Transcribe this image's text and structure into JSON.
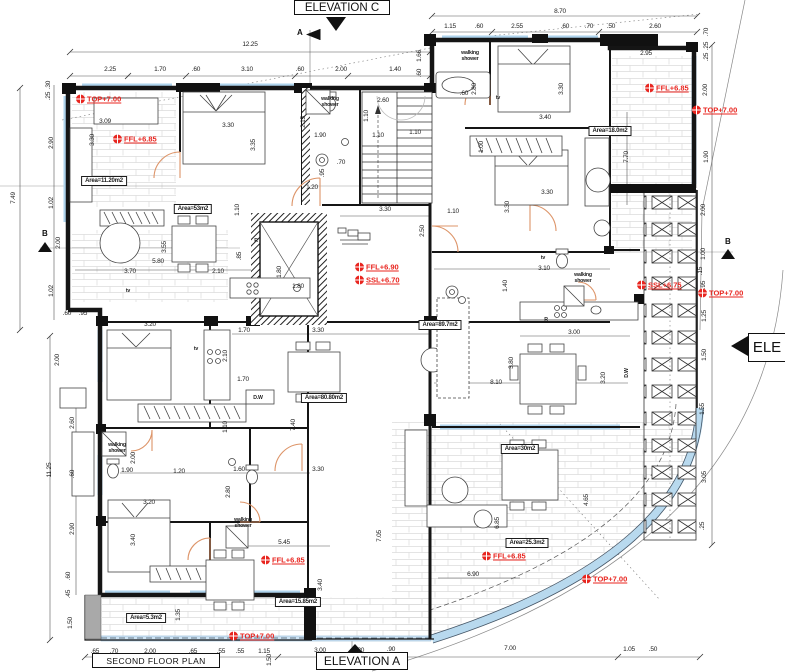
{
  "titles": {
    "plan": "SECOND FLOOR PLAN",
    "elevation_a": "ELEVATION A",
    "elevation_c": "ELEVATION C",
    "elevation_right": "ELE",
    "section_a": "A",
    "section_b": "B"
  },
  "colors": {
    "annotation_red": "#e8251f",
    "window_blue": "#aed3ec",
    "door_orange": "#dd9468",
    "wall_black": "#151515"
  },
  "red_annotations": [
    {
      "t": "TOP+7.00",
      "x": 76,
      "y": 99,
      "m": 1
    },
    {
      "t": "FFL+6.85",
      "x": 113,
      "y": 139,
      "m": 1
    },
    {
      "t": "FFL+6.85",
      "x": 645,
      "y": 88,
      "m": 1
    },
    {
      "t": "TOP+7.00",
      "x": 692,
      "y": 110,
      "m": 1
    },
    {
      "t": "FFL+6.90",
      "x": 355,
      "y": 267,
      "m": 1
    },
    {
      "t": "SSL+6.70",
      "x": 355,
      "y": 280,
      "m": 1
    },
    {
      "t": "SSL+6.75",
      "x": 637,
      "y": 285,
      "m": 1
    },
    {
      "t": "TOP+7.00",
      "x": 698,
      "y": 293,
      "m": 1
    },
    {
      "t": "FFL+6.85",
      "x": 261,
      "y": 560,
      "m": 1
    },
    {
      "t": "FFL+6.85",
      "x": 482,
      "y": 556,
      "m": 1
    },
    {
      "t": "TOP+7.00",
      "x": 582,
      "y": 579,
      "m": 1
    },
    {
      "t": "TOP+7.00",
      "x": 229,
      "y": 636,
      "m": 1
    }
  ],
  "area_labels": [
    {
      "t": "Area=11.20m2",
      "x": 104,
      "y": 181
    },
    {
      "t": "Area=53m2",
      "x": 193,
      "y": 209
    },
    {
      "t": "Area=18.0m2",
      "x": 610,
      "y": 131
    },
    {
      "t": "Area=89.7m2",
      "x": 440,
      "y": 325
    },
    {
      "t": "Area=80.80m2",
      "x": 324,
      "y": 398
    },
    {
      "t": "Area=30m2",
      "x": 520,
      "y": 449
    },
    {
      "t": "Area=25.3m2",
      "x": 527,
      "y": 543
    },
    {
      "t": "Area=15.85m2",
      "x": 298,
      "y": 602
    },
    {
      "t": "Area=5.3m2",
      "x": 146,
      "y": 618
    }
  ],
  "feature_labels": [
    {
      "t": "walking\nshower",
      "x": 330,
      "y": 103
    },
    {
      "t": "walking\nshower",
      "x": 470,
      "y": 57
    },
    {
      "t": "walking\nshower",
      "x": 583,
      "y": 279
    },
    {
      "t": "walking\nshower",
      "x": 117,
      "y": 449
    },
    {
      "t": "walking\nshower",
      "x": 243,
      "y": 524
    },
    {
      "t": "tv",
      "x": 128,
      "y": 292
    },
    {
      "t": "tv",
      "x": 196,
      "y": 350
    },
    {
      "t": "tv",
      "x": 498,
      "y": 99
    },
    {
      "t": "tv",
      "x": 543,
      "y": 259
    },
    {
      "t": "R",
      "x": 256,
      "y": 242
    },
    {
      "t": "R",
      "x": 546,
      "y": 321
    },
    {
      "t": "D.W",
      "x": 258,
      "y": 399
    },
    {
      "t": "D.W",
      "x": 628,
      "y": 373,
      "v": 1
    }
  ],
  "dim_labels": [
    {
      "t": "12.25",
      "x": 250,
      "y": 45
    },
    {
      "t": "2.25",
      "x": 110,
      "y": 70
    },
    {
      "t": "1.70",
      "x": 160,
      "y": 70
    },
    {
      "t": ".60",
      "x": 196,
      "y": 70
    },
    {
      "t": "3.10",
      "x": 247,
      "y": 70
    },
    {
      "t": ".60",
      "x": 300,
      "y": 70
    },
    {
      "t": "2.00",
      "x": 341,
      "y": 70
    },
    {
      "t": "1.40",
      "x": 395,
      "y": 70
    },
    {
      "t": "8.70",
      "x": 560,
      "y": 12
    },
    {
      "t": "1.15",
      "x": 450,
      "y": 27
    },
    {
      "t": ".60",
      "x": 479,
      "y": 27
    },
    {
      "t": "2.55",
      "x": 517,
      "y": 27
    },
    {
      "t": ".60",
      "x": 565,
      "y": 27
    },
    {
      "t": ".70",
      "x": 589,
      "y": 27
    },
    {
      "t": ".50",
      "x": 611,
      "y": 27
    },
    {
      "t": "2.60",
      "x": 655,
      "y": 27
    },
    {
      "t": "2.95",
      "x": 646,
      "y": 54
    },
    {
      "t": ".70",
      "x": 707,
      "y": 32,
      "v": 1
    },
    {
      "t": ".25",
      "x": 707,
      "y": 46,
      "v": 1
    },
    {
      "t": ".25",
      "x": 707,
      "y": 57,
      "v": 1
    },
    {
      "t": "2.00",
      "x": 706,
      "y": 90,
      "v": 1
    },
    {
      "t": "1.90",
      "x": 707,
      "y": 157,
      "v": 1
    },
    {
      "t": "7.70",
      "x": 627,
      "y": 157,
      "v": 1
    },
    {
      "t": "2.00",
      "x": 704,
      "y": 210,
      "v": 1
    },
    {
      "t": "1.00",
      "x": 704,
      "y": 254,
      "v": 1
    },
    {
      "t": ".15",
      "x": 701,
      "y": 271,
      "v": 1
    },
    {
      "t": ".95",
      "x": 704,
      "y": 285,
      "v": 1
    },
    {
      "t": "1.25",
      "x": 705,
      "y": 316,
      "v": 1
    },
    {
      "t": "1.50",
      "x": 705,
      "y": 355,
      "v": 1
    },
    {
      "t": "1.55",
      "x": 703,
      "y": 409,
      "v": 1
    },
    {
      "t": "3.05",
      "x": 705,
      "y": 477,
      "v": 1
    },
    {
      "t": ".25",
      "x": 703,
      "y": 526,
      "v": 1
    },
    {
      "t": ".30",
      "x": 49,
      "y": 85,
      "v": 1
    },
    {
      "t": ".25",
      "x": 49,
      "y": 96,
      "v": 1
    },
    {
      "t": "2.90",
      "x": 52,
      "y": 143,
      "v": 1
    },
    {
      "t": "7.49",
      "x": 14,
      "y": 198,
      "v": 1
    },
    {
      "t": "1.02",
      "x": 52,
      "y": 203,
      "v": 1
    },
    {
      "t": "2.00",
      "x": 59,
      "y": 243,
      "v": 1
    },
    {
      "t": "1.02",
      "x": 52,
      "y": 291,
      "v": 1
    },
    {
      "t": ".60",
      "x": 67,
      "y": 314
    },
    {
      "t": ".95",
      "x": 83,
      "y": 314
    },
    {
      "t": "2.00",
      "x": 58,
      "y": 360,
      "v": 1
    },
    {
      "t": "11.25",
      "x": 50,
      "y": 470,
      "v": 1
    },
    {
      "t": "2.60",
      "x": 73,
      "y": 423,
      "v": 1
    },
    {
      "t": ".60",
      "x": 73,
      "y": 474,
      "v": 1
    },
    {
      "t": "2.90",
      "x": 73,
      "y": 529,
      "v": 1
    },
    {
      "t": ".60",
      "x": 69,
      "y": 576,
      "v": 1
    },
    {
      "t": ".45",
      "x": 69,
      "y": 594,
      "v": 1
    },
    {
      "t": "1.50",
      "x": 71,
      "y": 623,
      "v": 1
    },
    {
      "t": ".65",
      "x": 95,
      "y": 652
    },
    {
      "t": ".70",
      "x": 114,
      "y": 652
    },
    {
      "t": "2.00",
      "x": 150,
      "y": 652
    },
    {
      "t": ".65",
      "x": 193,
      "y": 652
    },
    {
      "t": ".55",
      "x": 221,
      "y": 652
    },
    {
      "t": ".55",
      "x": 240,
      "y": 652
    },
    {
      "t": "1.15",
      "x": 264,
      "y": 652
    },
    {
      "t": "3.00",
      "x": 320,
      "y": 651
    },
    {
      "t": ".20",
      "x": 360,
      "y": 651
    },
    {
      "t": ".90",
      "x": 391,
      "y": 650
    },
    {
      "t": "7.00",
      "x": 510,
      "y": 649
    },
    {
      "t": "1.05",
      "x": 629,
      "y": 650
    },
    {
      "t": ".50",
      "x": 653,
      "y": 650
    },
    {
      "t": "1.50",
      "x": 270,
      "y": 660,
      "v": 1
    },
    {
      "t": "3.09",
      "x": 105,
      "y": 122
    },
    {
      "t": "3.30",
      "x": 93,
      "y": 140,
      "v": 1
    },
    {
      "t": "3.30",
      "x": 228,
      "y": 126
    },
    {
      "t": "3.35",
      "x": 254,
      "y": 145,
      "v": 1
    },
    {
      "t": "2.15",
      "x": 304,
      "y": 122,
      "v": 1
    },
    {
      "t": "1.90",
      "x": 320,
      "y": 136
    },
    {
      "t": "1.10",
      "x": 378,
      "y": 136
    },
    {
      "t": "2.60",
      "x": 383,
      "y": 101
    },
    {
      "t": "1.10",
      "x": 367,
      "y": 116,
      "v": 1
    },
    {
      "t": "1.10",
      "x": 415,
      "y": 133
    },
    {
      "t": ".70",
      "x": 341,
      "y": 163
    },
    {
      "t": ".95",
      "x": 323,
      "y": 173,
      "v": 1
    },
    {
      "t": "1.20",
      "x": 312,
      "y": 188
    },
    {
      "t": "1.10",
      "x": 238,
      "y": 210,
      "v": 1
    },
    {
      "t": "3.55",
      "x": 165,
      "y": 247,
      "v": 1
    },
    {
      "t": "5.80",
      "x": 158,
      "y": 262
    },
    {
      "t": "3.70",
      "x": 130,
      "y": 272
    },
    {
      "t": "2.10",
      "x": 218,
      "y": 272
    },
    {
      "t": ".85",
      "x": 240,
      "y": 256,
      "v": 1
    },
    {
      "t": "1.80",
      "x": 280,
      "y": 272,
      "v": 1
    },
    {
      "t": "1.80",
      "x": 298,
      "y": 287
    },
    {
      "t": "3.30",
      "x": 385,
      "y": 210
    },
    {
      "t": "2.50",
      "x": 423,
      "y": 231,
      "v": 1
    },
    {
      "t": "1.10",
      "x": 453,
      "y": 212
    },
    {
      "t": "3.30",
      "x": 508,
      "y": 207,
      "v": 1
    },
    {
      "t": "2.80",
      "x": 475,
      "y": 89,
      "v": 1
    },
    {
      "t": "3.30",
      "x": 562,
      "y": 89,
      "v": 1
    },
    {
      "t": "3.40",
      "x": 545,
      "y": 118
    },
    {
      "t": "1.66",
      "x": 420,
      "y": 56,
      "v": 1
    },
    {
      "t": ".60",
      "x": 420,
      "y": 73,
      "v": 1
    },
    {
      "t": ".60",
      "x": 464,
      "y": 94
    },
    {
      "t": "1.00",
      "x": 482,
      "y": 147,
      "v": 1
    },
    {
      "t": "3.30",
      "x": 547,
      "y": 193
    },
    {
      "t": "1.40",
      "x": 506,
      "y": 286,
      "v": 1
    },
    {
      "t": "3.10",
      "x": 544,
      "y": 269
    },
    {
      "t": "3.00",
      "x": 574,
      "y": 333
    },
    {
      "t": "3.80",
      "x": 512,
      "y": 363,
      "v": 1
    },
    {
      "t": "3.20",
      "x": 604,
      "y": 378,
      "v": 1
    },
    {
      "t": "8.10",
      "x": 496,
      "y": 383
    },
    {
      "t": "2.10",
      "x": 226,
      "y": 356,
      "v": 1
    },
    {
      "t": "3.20",
      "x": 150,
      "y": 325
    },
    {
      "t": "1.70",
      "x": 244,
      "y": 331
    },
    {
      "t": "3.30",
      "x": 318,
      "y": 331
    },
    {
      "t": "1.70",
      "x": 243,
      "y": 380
    },
    {
      "t": "7.40",
      "x": 294,
      "y": 425,
      "v": 1
    },
    {
      "t": "1.10",
      "x": 226,
      "y": 427,
      "v": 1
    },
    {
      "t": "2.00",
      "x": 134,
      "y": 458,
      "v": 1
    },
    {
      "t": "1.90",
      "x": 127,
      "y": 471
    },
    {
      "t": "1.20",
      "x": 179,
      "y": 472
    },
    {
      "t": "1.60",
      "x": 239,
      "y": 470
    },
    {
      "t": "3.30",
      "x": 318,
      "y": 470
    },
    {
      "t": "2.80",
      "x": 229,
      "y": 492,
      "v": 1
    },
    {
      "t": "3.20",
      "x": 149,
      "y": 503
    },
    {
      "t": "3.40",
      "x": 134,
      "y": 540,
      "v": 1
    },
    {
      "t": "5.45",
      "x": 284,
      "y": 543
    },
    {
      "t": "7.05",
      "x": 380,
      "y": 536,
      "v": 1
    },
    {
      "t": "3.40",
      "x": 321,
      "y": 585,
      "v": 1
    },
    {
      "t": "1.35",
      "x": 179,
      "y": 615,
      "v": 1
    },
    {
      "t": "4.65",
      "x": 587,
      "y": 500,
      "v": 1
    },
    {
      "t": "6.85",
      "x": 498,
      "y": 523,
      "v": 1
    },
    {
      "t": "6.90",
      "x": 473,
      "y": 575
    }
  ]
}
